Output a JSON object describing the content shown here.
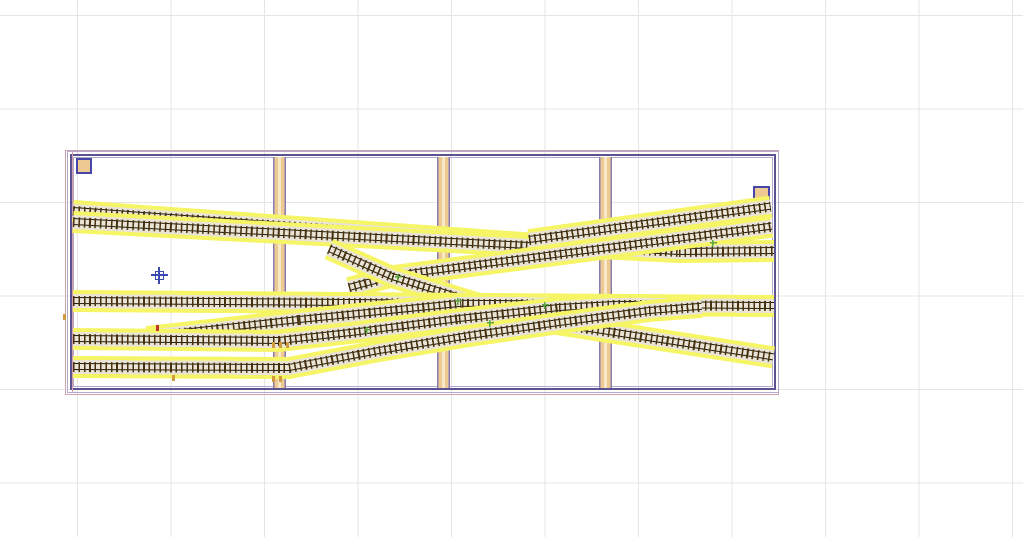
{
  "app": {
    "description": "model railroad track plan CAD canvas, empty workspace with baseboard and yard trackwork"
  },
  "canvas": {
    "width": 1023,
    "height": 537,
    "bg": "#ffffff"
  },
  "grid": {
    "step": 93.5,
    "offset_x": 77,
    "offset_y": 15,
    "color": "#e5e5e5"
  },
  "colors": {
    "frame_light": "#b2aacd",
    "frame_dark": "#5b5391",
    "frame_pink": "#d2a0ae",
    "beam_fill": "#ecca92",
    "beam_edge": "#8a7cb0",
    "beam_center": "#f7e9c8",
    "track_yellow": "#f6f565",
    "track_roadbed": "#e9e4d5",
    "track_tie": "#46310f",
    "track_rail": "#251a07",
    "square_border": "#4646a8",
    "cursor_blue": "#3c49ae",
    "green_node": "#5aa540",
    "red_tick": "#c43333",
    "tan_tick": "#d09a3e"
  },
  "board": {
    "pink": {
      "x": 65,
      "y": 150,
      "w": 714,
      "h": 245
    },
    "outer": {
      "x": 67,
      "y": 151,
      "w": 712,
      "h": 242
    },
    "mid": {
      "x": 70,
      "y": 154,
      "w": 706,
      "h": 236
    },
    "inner": {
      "x": 73,
      "y": 157,
      "w": 700,
      "h": 230
    },
    "pink_left_line": {
      "x": 72,
      "y1": 152,
      "y2": 392
    }
  },
  "beams": {
    "width": 13,
    "y1": 157,
    "y2": 388,
    "items": [
      {
        "x": 273
      },
      {
        "x": 437
      },
      {
        "x": 599
      }
    ]
  },
  "corner_blocks": [
    {
      "x": 76,
      "y": 158,
      "w": 16,
      "h": 16
    },
    {
      "x": 753,
      "y": 186,
      "w": 17,
      "h": 15
    }
  ],
  "tracks": [
    {
      "id": "main-upper-1",
      "points": [
        [
          74,
          211
        ],
        [
          580,
          247
        ],
        [
          680,
          252
        ],
        [
          772,
          251
        ]
      ]
    },
    {
      "id": "main-upper-2",
      "points": [
        [
          74,
          222
        ],
        [
          530,
          246
        ]
      ]
    },
    {
      "id": "siding-upper-right-1",
      "points": [
        [
          530,
          240
        ],
        [
          769,
          207
        ]
      ]
    },
    {
      "id": "siding-upper-right-2",
      "points": [
        [
          350,
          288
        ],
        [
          395,
          276
        ],
        [
          770,
          227
        ]
      ]
    },
    {
      "id": "crossover-descending",
      "points": [
        [
          330,
          249
        ],
        [
          393,
          277
        ],
        [
          480,
          304
        ],
        [
          545,
          322
        ],
        [
          772,
          357
        ]
      ]
    },
    {
      "id": "main-middle",
      "points": [
        [
          74,
          301
        ],
        [
          772,
          306
        ]
      ]
    },
    {
      "id": "ladder-left",
      "points": [
        [
          148,
          337
        ],
        [
          300,
          320
        ],
        [
          460,
          304
        ]
      ]
    },
    {
      "id": "yard-track-2",
      "points": [
        [
          74,
          339
        ],
        [
          280,
          341
        ],
        [
          360,
          332
        ],
        [
          460,
          319
        ],
        [
          560,
          308
        ],
        [
          615,
          305
        ]
      ]
    },
    {
      "id": "yard-track-3",
      "points": [
        [
          74,
          367
        ],
        [
          290,
          368
        ],
        [
          380,
          351
        ],
        [
          470,
          336
        ],
        [
          560,
          323
        ],
        [
          650,
          311
        ],
        [
          700,
          307
        ]
      ]
    }
  ],
  "markers": {
    "cursor": {
      "x": 159,
      "y": 275
    },
    "green_nodes": [
      [
        398,
        277
      ],
      [
        458,
        301
      ],
      [
        490,
        323
      ],
      [
        367,
        330
      ],
      [
        713,
        243
      ],
      [
        545,
        305
      ]
    ],
    "red_ticks": [
      [
        157,
        328
      ]
    ],
    "tan_ticks": [
      [
        273,
        345
      ],
      [
        280,
        345
      ],
      [
        287,
        345
      ],
      [
        273,
        379
      ],
      [
        280,
        379
      ],
      [
        173,
        378
      ],
      [
        64,
        317
      ]
    ]
  }
}
